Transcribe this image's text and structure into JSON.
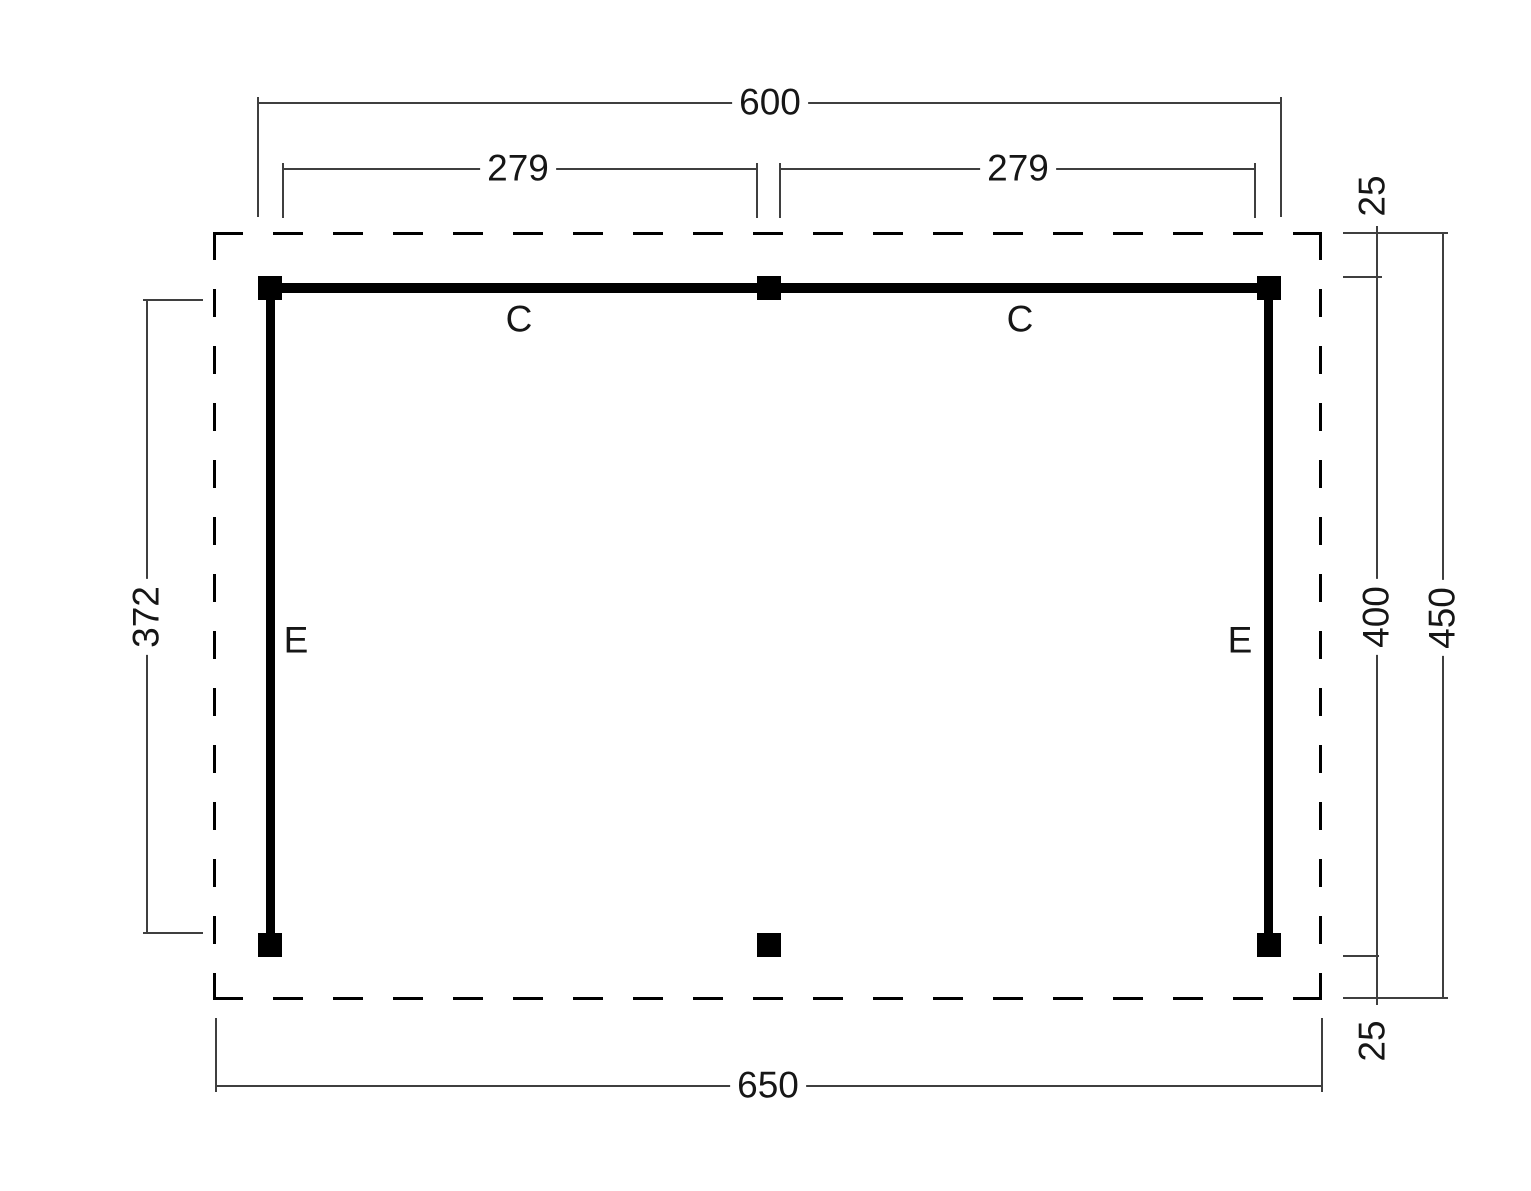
{
  "labels": {
    "beam_top_left": "C",
    "beam_top_right": "C",
    "beam_side_left": "E",
    "beam_side_right": "E"
  },
  "dimensions": {
    "post_span_width": "600",
    "bay_left": "279",
    "bay_right": "279",
    "overhang_top": "25",
    "frame_depth": "400",
    "roof_depth": "450",
    "overhang_bottom": "25",
    "post_height_left": "372",
    "roof_width": "650"
  },
  "colors": {
    "structure": "#000000",
    "dimension_lines": "#3f3f3f",
    "background": "#ffffff"
  }
}
